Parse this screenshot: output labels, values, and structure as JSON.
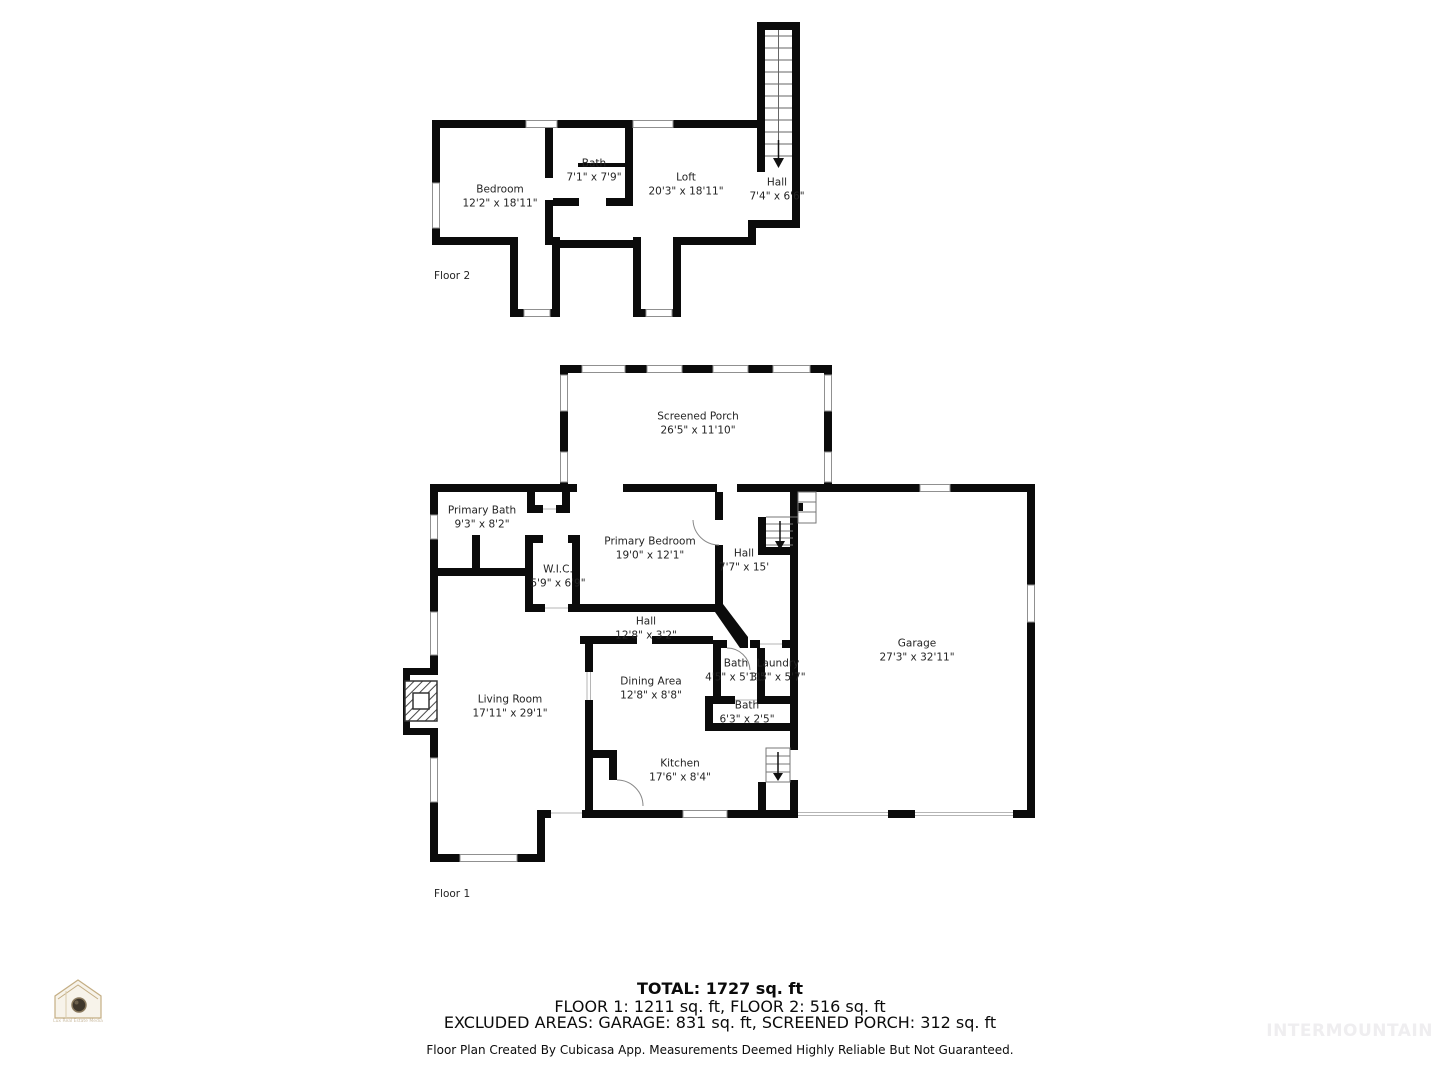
{
  "floor2": {
    "label": "Floor 2",
    "rooms": [
      {
        "name": "Bedroom",
        "dims": "12'2\" x 18'11\""
      },
      {
        "name": "Bath",
        "dims": "7'1\" x 7'9\""
      },
      {
        "name": "Loft",
        "dims": "20'3\" x 18'11\""
      },
      {
        "name": "Hall",
        "dims": "7'4\" x 6'6\""
      }
    ]
  },
  "floor1": {
    "label": "Floor 1",
    "rooms": [
      {
        "name": "Screened Porch",
        "dims": "26'5\" x 11'10\""
      },
      {
        "name": "Primary Bath",
        "dims": "9'3\" x 8'2\""
      },
      {
        "name": "Primary Bedroom",
        "dims": "19'0\" x 12'1\""
      },
      {
        "name": "W.I.C.",
        "dims": "5'9\" x 6'9\""
      },
      {
        "name": "Hall",
        "dims": "7'7\" x 15'"
      },
      {
        "name": "Hall",
        "dims": "12'8\" x 3'2\""
      },
      {
        "name": "Living Room",
        "dims": "17'11\" x 29'1\""
      },
      {
        "name": "Dining Area",
        "dims": "12'8\" x 8'8\""
      },
      {
        "name": "Bath",
        "dims": "4'5\" x 5'11\""
      },
      {
        "name": "Laundry",
        "dims": "3'5\" x 5'7\""
      },
      {
        "name": "Bath",
        "dims": "6'3\" x 2'5\""
      },
      {
        "name": "Kitchen",
        "dims": "17'6\" x 8'4\""
      },
      {
        "name": "Garage",
        "dims": "27'3\" x 32'11\""
      }
    ]
  },
  "summary": {
    "total": "TOTAL: 1727 sq. ft",
    "floors": "FLOOR 1: 1211 sq. ft, FLOOR 2: 516 sq. ft",
    "excluded": "EXCLUDED AREAS: GARAGE: 831 sq. ft, SCREENED PORCH: 312 sq. ft",
    "disclaimer": "Floor Plan Created By Cubicasa App. Measurements Deemed Highly Reliable But Not Guaranteed."
  },
  "watermark": "INTERMOUNTAIN",
  "logo": {
    "caption": "Lux Real Estate Media"
  },
  "colors": {
    "wall": "#0b0b0b",
    "label_text": "#242424",
    "window_stroke": "#909090",
    "watermark_text": "#efeef0",
    "logo_gold": "#c4ae84"
  }
}
